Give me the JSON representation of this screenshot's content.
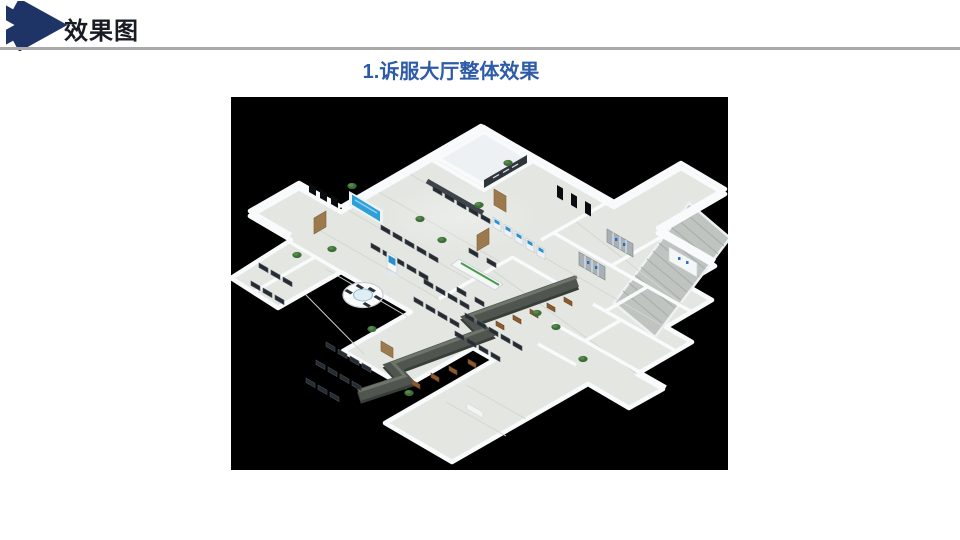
{
  "header": {
    "title": "效果图"
  },
  "subtitle": {
    "text": "1.诉服大厅整体效果"
  },
  "colors": {
    "accent_navy": "#1e3366",
    "subtitle_blue": "#2e5ba8",
    "divider_gray": "#a9a9a9",
    "figure_background": "#000000",
    "floor": "#e3e6e1",
    "walls": "#f8fafb",
    "service_counter": "#50564f",
    "led_screen_blue": "#2e9fd8",
    "chair_dark": "#262b31",
    "chair_brown": "#8a5a30",
    "plant_green": "#3f6d3a",
    "cabinet_gray": "#a9b0b5"
  }
}
